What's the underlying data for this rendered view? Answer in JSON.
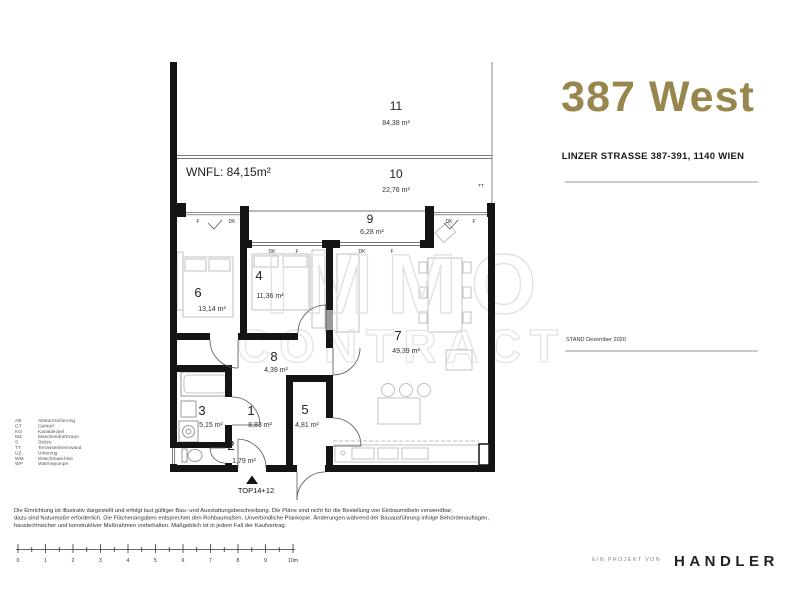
{
  "header": {
    "title": "387 West",
    "address": "LINZER STRASSE 387-391, 1140 WIEN",
    "stand": "STAND Dezember 2020"
  },
  "plan": {
    "wnfl": "WNFL: 84,15m²",
    "entrance_label": "TOP14+12",
    "tt_label": "TT",
    "watermark": {
      "line1": "IMMO",
      "line2": "CONTRACT"
    },
    "window_labels": {
      "f": "F",
      "dk": "DK"
    },
    "rooms": [
      {
        "number": "11",
        "area": "84,38 m²"
      },
      {
        "number": "10",
        "area": "22,76 m²"
      },
      {
        "number": "9",
        "area": "6,28 m²"
      },
      {
        "number": "6",
        "area": "13,14 m²"
      },
      {
        "number": "4",
        "area": "11,36 m²"
      },
      {
        "number": "7",
        "area": "49,39 m²"
      },
      {
        "number": "8",
        "area": "4,39 m²"
      },
      {
        "number": "3",
        "area": "5,15 m²"
      },
      {
        "number": "1",
        "area": "8,83 m²"
      },
      {
        "number": "5",
        "area": "4,81 m²"
      },
      {
        "number": "2",
        "area": "1,79 m²"
      }
    ]
  },
  "legend": {
    "items": [
      {
        "abbr": "AB",
        "label": "Absturzsicherung"
      },
      {
        "abbr": "GT",
        "label": "Gehtürl"
      },
      {
        "abbr": "KO",
        "label": "Kanaldeckel"
      },
      {
        "abbr": "MZ",
        "label": "Maschendrahtzaun"
      },
      {
        "abbr": "S",
        "label": "Stütze"
      },
      {
        "abbr": "TT",
        "label": "Terrassentrennwand"
      },
      {
        "abbr": "UZ",
        "label": "Unterzug"
      },
      {
        "abbr": "WM",
        "label": "Waschmaschine"
      },
      {
        "abbr": "WP",
        "label": "Wärmepumpe"
      }
    ]
  },
  "disclaimer": {
    "line1": "Die Einrichtung ist illustrativ dargestellt und erfolgt laut gültiger Bau- und Ausstattungsbeschreibung. Die Pläne sind nicht für die Bestellung von Einbaumöbeln verwendbar;",
    "line2": "dazu sind Naturmaße erforderlich. Die Flächenangaben entsprechen den Rohbaumaßen. Unverbindliche Plankopie. Änderungen während der Bauausführung infolge Behördenauflagen,",
    "line3": "haustechnischer und konstruktiver Maßnahmen vorbehalten. Maßgeblich ist in jedem Fall der Kaufvertrag."
  },
  "scale_bar": {
    "labels": [
      "0",
      "1",
      "2",
      "3",
      "4",
      "5",
      "6",
      "7",
      "8",
      "9",
      "10m"
    ]
  },
  "footer": {
    "prefix": "EIN PROJEKT VON",
    "company": "HANDLER"
  },
  "colors": {
    "brand_gold": "#97874e",
    "wall": "#141414",
    "furniture": "#c4c4c4",
    "watermark": "#e2e2e2"
  }
}
